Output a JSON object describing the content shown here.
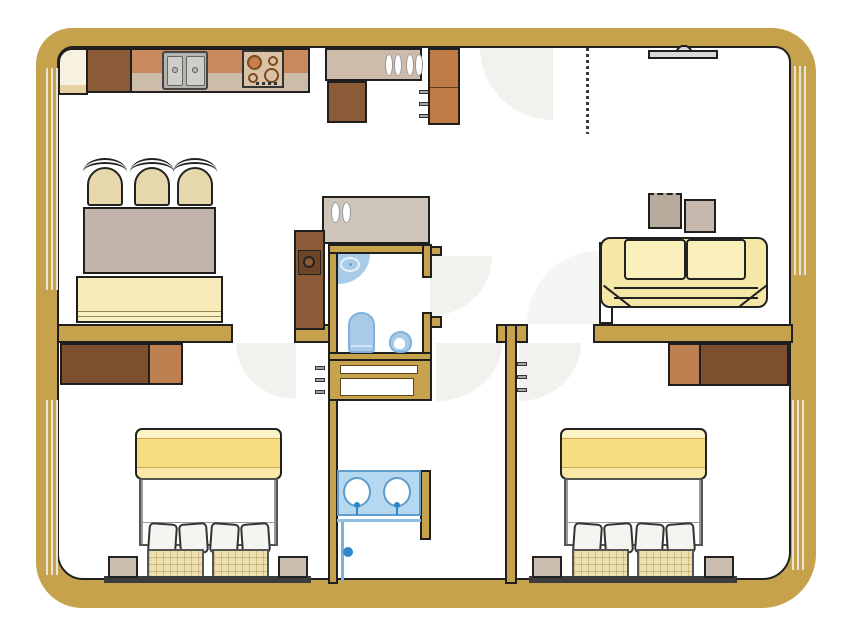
{
  "meta": {
    "type": "apartment-floor-plan",
    "view": "top-down architectural drawing, no text labels",
    "canvas": {
      "width": 853,
      "height": 640
    }
  },
  "palette": {
    "wall": "#c7a24c",
    "outline": "#1f1f1f",
    "floor": "#ffffff",
    "door_swing": "#f1f1ee",
    "window_line": "#e9e5d6",
    "cabinet_dark_brown": "#7d4f2e",
    "cabinet_mid_brown": "#8b5a36",
    "cabinet_light_brown": "#be8050",
    "cabinet_orange": "#c07c46",
    "counter_orange": "#c9895c",
    "counter_tan": "#cdbca9",
    "table_gray": "#c3b4ab",
    "seat_cream": "#e7d7ad",
    "bench_yellow": "#f7ecb9",
    "sofa_yellow": "#f5e8a6",
    "bed_yellow": "#f8dd80",
    "fixture_blue": "#a9cbe8",
    "fixture_blue_dark": "#5f9dcd",
    "handle_blue": "#2f86c8",
    "plaid_cream": "#ecdfae",
    "nightstand_tan": "#cbbdb0",
    "steel_gray": "#b4b4ae",
    "tv_gray": "#d9d9d6"
  },
  "rooms": {
    "kitchen": {
      "label": "Kitchen"
    },
    "dining": {
      "label": "Dining area"
    },
    "living": {
      "label": "Living room"
    },
    "entry": {
      "label": "Entry"
    },
    "bathroom": {
      "label": "Bathroom with toilet and bidet"
    },
    "hallway": {
      "label": "Hallway"
    },
    "shared_bathroom": {
      "label": "Shower bathroom with double vanity"
    },
    "bedroom_left": {
      "label": "Left bedroom"
    },
    "bedroom_right": {
      "label": "Right bedroom"
    }
  },
  "fixtures": {
    "outer_wall": "Exterior wall",
    "window": "Window",
    "interior_wall": "Interior wall",
    "door_swing": "Door swing arc",
    "door_leaf": "Open door leaf",
    "dashed_divider": "Dashed partition line",
    "corner_counter": "Corner counter unit",
    "kitchen_cabinet": "Kitchen cabinet",
    "kitchen_counter": "Kitchen counter",
    "kitchen_sink": "Double-basin kitchen sink",
    "stove": "Four-burner cooktop",
    "dish_counter": "Counter with dishes",
    "tall_cabinet": "Tall cabinet / fridge",
    "dining_chair": "Dining chair",
    "dining_table": "Dining table",
    "dining_bench": "Bench table",
    "tv": "Wall-mounted TV",
    "side_table": "Side table",
    "sofa": "Two-seat sofa",
    "dresser": "Dresser / sideboard",
    "appliance": "Appliance cabinet",
    "corner_basin": "Corner washbasin",
    "toilet": "Toilet",
    "bidet": "Bidet",
    "linen_closet": "Shelved closet",
    "vanity": "Double washbasin vanity",
    "shower_door": "Shower door with handle",
    "bed": "Double bed with pillows",
    "pillow": "Pillow",
    "mattress": "Plaid mattress",
    "nightstand": "Nightstand",
    "headboard": "Headboard"
  }
}
